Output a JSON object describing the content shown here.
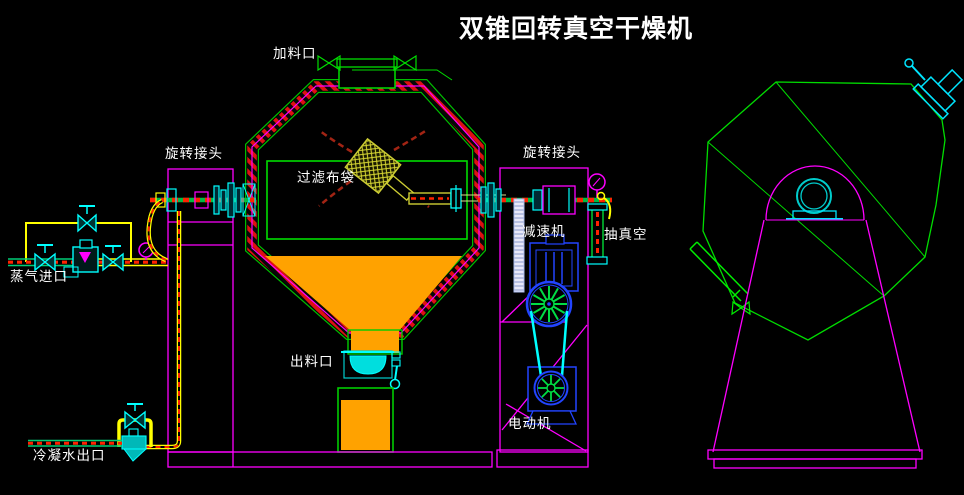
{
  "title": "双锥回转真空干燥机",
  "labels": {
    "feed_port": "加料口",
    "rotary_joint_left": "旋转接头",
    "rotary_joint_right": "旋转接头",
    "filter_bag": "过滤布袋",
    "steam_inlet": "蒸气进口",
    "reducer": "减速机",
    "vacuum": "抽真空",
    "discharge_port": "出料口",
    "motor": "电动机",
    "condensate_outlet": "冷凝水出口"
  },
  "colors": {
    "background": "#000000",
    "outline_magenta": "#ff00ff",
    "outline_green": "#00dd00",
    "cyan": "#00ffff",
    "yellow": "#ffff00",
    "material_orange": "#ffa200",
    "hatch_red": "#dd1111",
    "dash_red": "#ff2200",
    "machine_blue": "#2244ff",
    "bag_khaki": "#d8d833",
    "text_white": "#ffffff"
  }
}
